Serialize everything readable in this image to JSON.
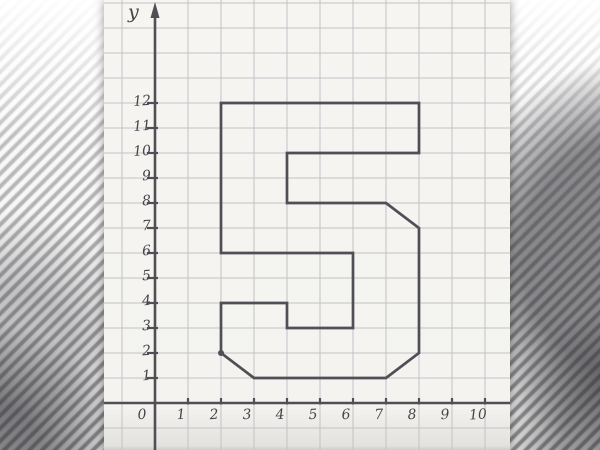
{
  "background": {
    "stripe_light": "#f2f2f2",
    "stripe_dark": "#8f8f94",
    "shadow_blob": "#2f2f34"
  },
  "paper": {
    "color": "#f4f3ef",
    "grid_color": "#c2c2c9",
    "pencil_color": "#4f4f55",
    "label_color": "#45454b"
  },
  "chart_data": {
    "type": "line",
    "title": "",
    "xlabel": "",
    "ylabel": "y",
    "origin_label": "0",
    "x_tick_labels": [
      "1",
      "2",
      "3",
      "4",
      "5",
      "6",
      "7",
      "8",
      "9",
      "10"
    ],
    "y_tick_labels": [
      "1",
      "2",
      "3",
      "4",
      "5",
      "6",
      "7",
      "8",
      "9",
      "10",
      "11",
      "12"
    ],
    "xlim": [
      0,
      10.7
    ],
    "ylim": [
      0,
      16.1
    ],
    "grid": true,
    "legend": false,
    "series": [
      {
        "name": "numeral-5-outline",
        "closed": true,
        "points": [
          [
            2,
            12
          ],
          [
            8,
            12
          ],
          [
            8,
            10
          ],
          [
            4,
            10
          ],
          [
            4,
            8
          ],
          [
            7,
            8
          ],
          [
            8,
            7
          ],
          [
            8,
            2
          ],
          [
            7,
            1
          ],
          [
            3,
            1
          ],
          [
            2,
            2
          ],
          [
            2,
            4
          ],
          [
            4,
            4
          ],
          [
            4,
            3
          ],
          [
            6,
            3
          ],
          [
            6,
            6
          ],
          [
            2,
            6
          ]
        ]
      }
    ],
    "marked_points": [
      [
        2,
        2
      ]
    ]
  }
}
